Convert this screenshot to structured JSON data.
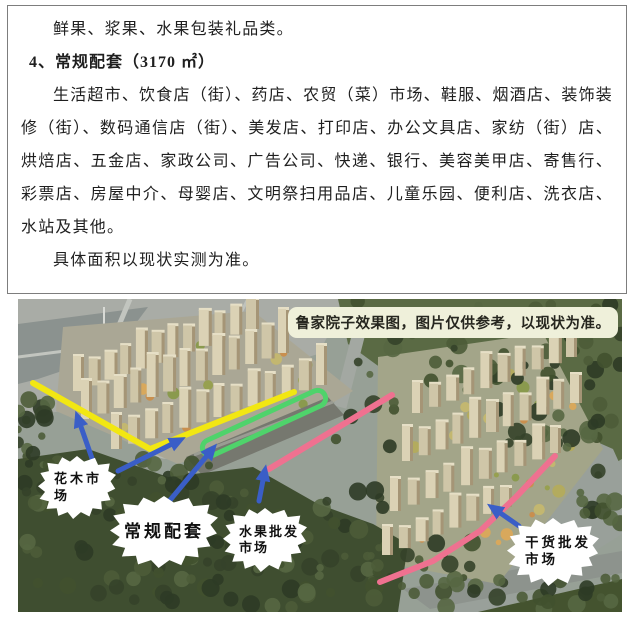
{
  "document": {
    "intro": "鲜果、浆果、水果包装礼品类。",
    "heading": "4、常规配套（3170 ㎡）",
    "body": "生活超市、饮食店（街）、药店、农贸（菜）市场、鞋服、烟酒店、装饰装修（街）、数码通信店（街）、美发店、打印店、办公文具店、家纺（街）店、烘焙店、五金店、家政公司、广告公司、快递、银行、美容美甲店、寄售行、彩票店、房屋中介、母婴店、文明祭扫用品店、儿童乐园、便利店、洗衣店、水站及其他。",
    "note": "具体面积以现状实测为准。"
  },
  "figure": {
    "caption": "鲁家院子效果图，图片仅供参考，以现状为准。",
    "labels": {
      "huamu_line1": "花木市",
      "huamu_line2": "场",
      "changgui": "常规配套",
      "shuiguo_line1": "水果批发",
      "shuiguo_line2": "市场",
      "ganhuo_line1": "干货批发",
      "ganhuo_line2": "市场"
    },
    "colors": {
      "route_yellow": "#f2e712",
      "route_green": "#4fd36b",
      "route_pink": "#ef7190",
      "arrow_blue": "#3a5ec7",
      "caption_bg": "#eff0da",
      "caption_text": "#26261f"
    }
  }
}
